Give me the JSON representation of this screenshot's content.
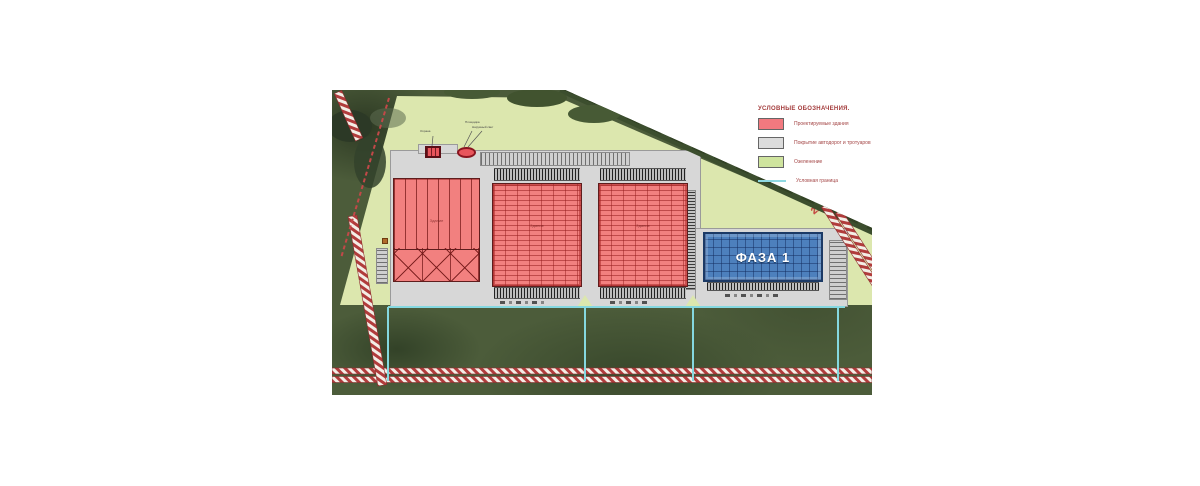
{
  "legend": {
    "title": "УСЛОВНЫЕ ОБОЗНАЧЕНИЯ.",
    "items": [
      {
        "label": "Проектируемые здания",
        "swatch": "#f2797f"
      },
      {
        "label": "Покрытие автодорог и тротуаров",
        "swatch": "#dcdcdc"
      },
      {
        "label": "Озеленение",
        "swatch": "#cfe49e"
      },
      {
        "label": "Условная граница",
        "swatch": "#8fd9e2"
      }
    ]
  },
  "map": {
    "phase_label": "ФАЗА 1",
    "road_marker": "22",
    "buildings": {
      "b1_label": "Здание",
      "b2_label": "Здание",
      "b3_label": "Здание"
    },
    "annotations": {
      "a1": "Охрана",
      "a2_line1": "Площадка",
      "a2_line2": "Наружный свет"
    }
  },
  "colors": {
    "building_fill": "#f2797f",
    "pavement": "#d7d7d7",
    "landscaping": "#dce7ae",
    "boundary_line": "#8fd9e2",
    "phase_fill": "#4d80bd",
    "road_hatch": "#b13c3c"
  }
}
